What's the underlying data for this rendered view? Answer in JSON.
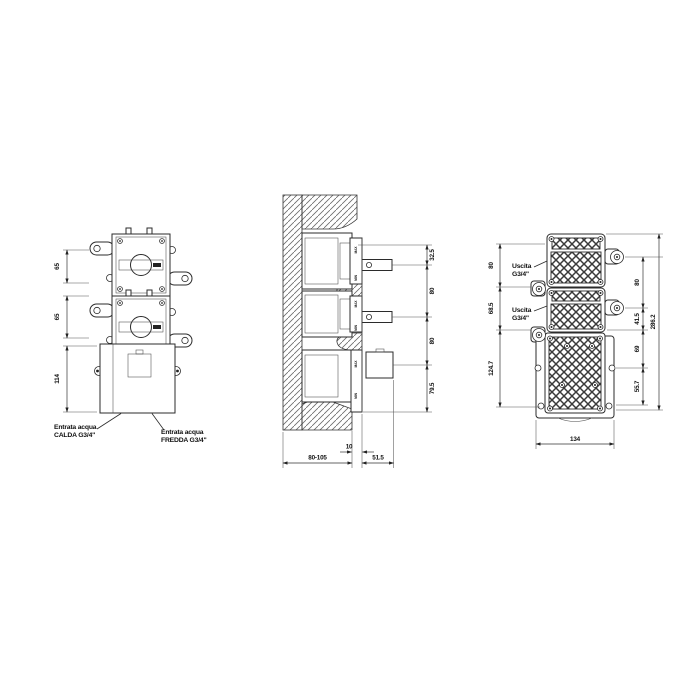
{
  "front_view": {
    "dims": {
      "d1": "65",
      "d2": "65",
      "d3": "114"
    },
    "hot_label": {
      "line1": "Entrata acqua",
      "line2": "CALDA G3/4\""
    },
    "cold_label": {
      "line1": "Entrata acqua",
      "line2": "FREDDA G3/4\""
    }
  },
  "section_view": {
    "dims_right": {
      "d1": "32.5",
      "d2": "80",
      "d3": "80",
      "d4": "79.5"
    },
    "dims_bottom": {
      "offset": "10",
      "depth": "80-105",
      "protrusion": "51.5"
    },
    "markings": {
      "max": "MAX",
      "min": "MIN"
    }
  },
  "back_view": {
    "dims_left": {
      "d1": "80",
      "d2": "68.5",
      "d3": "124.7"
    },
    "dims_right": {
      "d1": "80",
      "d2": "41.5",
      "d3": "69",
      "d4": "55.7",
      "total": "286.2"
    },
    "dim_bottom": "134",
    "outlet1": {
      "line1": "Uscita",
      "line2": "G3/4\""
    },
    "outlet2": {
      "line1": "Uscita",
      "line2": "G3/4\""
    }
  }
}
